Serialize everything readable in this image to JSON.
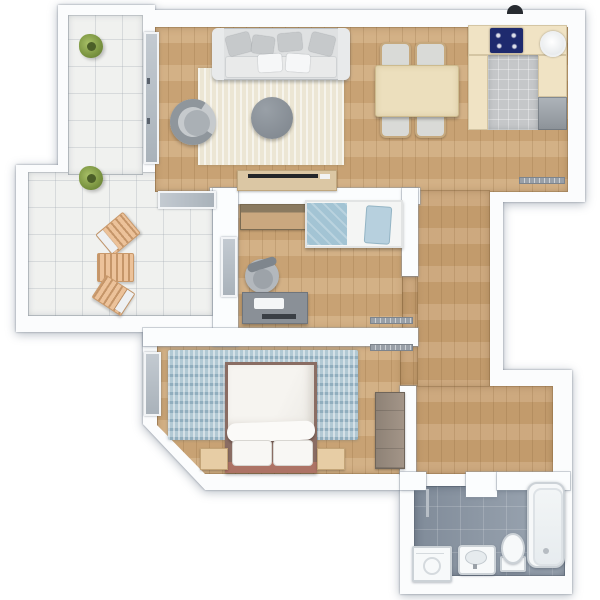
{
  "canvas": {
    "width": 600,
    "height": 600
  },
  "palette": {
    "wall": "#fbfcfd",
    "wall_shadow": "#9aa6b5",
    "wood_floor": "#cfa97a",
    "terrace_tile": "#f0f1ef",
    "bathroom_tile": "#97a2af",
    "kitchen_tile": "#c5c7c9",
    "kitchen_counter": "#f0e3c4",
    "cooktop_navy": "#1e2a6e",
    "living_rug": "#ece6d4",
    "bedroom_rug": "#b2c9d4",
    "bed_headboard": "#ad7365",
    "window_glass": "#b4bcc4",
    "plant_green": "#7a9440",
    "lounge_wood": "#ecc29a",
    "sofa_gray": "#dfe1e2",
    "desk_gray": "#8a9097"
  },
  "rooms": {
    "terrace": {
      "label": "Terrace",
      "floor": "light tile",
      "items": [
        "plant",
        "plant",
        "lounge chair",
        "lounge chair",
        "lounge chair"
      ]
    },
    "living_room": {
      "label": "Living room",
      "floor": "wood",
      "items": [
        "sofa with pillows",
        "cream rug",
        "round coffee table",
        "armchair",
        "TV sideboard"
      ]
    },
    "dining_area": {
      "label": "Dining area",
      "floor": "wood",
      "items": [
        "dining table",
        "chair",
        "chair",
        "chair",
        "chair",
        "radiator"
      ]
    },
    "kitchen": {
      "label": "Kitchen",
      "floor": "gray tile",
      "items": [
        "counter",
        "cooktop",
        "round sink",
        "appliance"
      ]
    },
    "office": {
      "label": "Second bedroom / office",
      "floor": "wood",
      "items": [
        "single bed",
        "dresser",
        "desk with laptop",
        "office chair"
      ]
    },
    "bedroom": {
      "label": "Master bedroom",
      "floor": "wood",
      "items": [
        "double bed",
        "blue rug",
        "nightstand",
        "nightstand",
        "wardrobe"
      ]
    },
    "hallway": {
      "label": "Hallway",
      "floor": "wood",
      "items": [
        "radiator",
        "radiator"
      ]
    },
    "bathroom": {
      "label": "Bathroom",
      "floor": "gray tile",
      "items": [
        "bathtub",
        "toilet",
        "washbasin",
        "washing machine",
        "towel radiator"
      ]
    }
  },
  "openings": {
    "windows": 3,
    "glass_doors": 1,
    "door_openings": 3,
    "roof_vent": 1
  }
}
